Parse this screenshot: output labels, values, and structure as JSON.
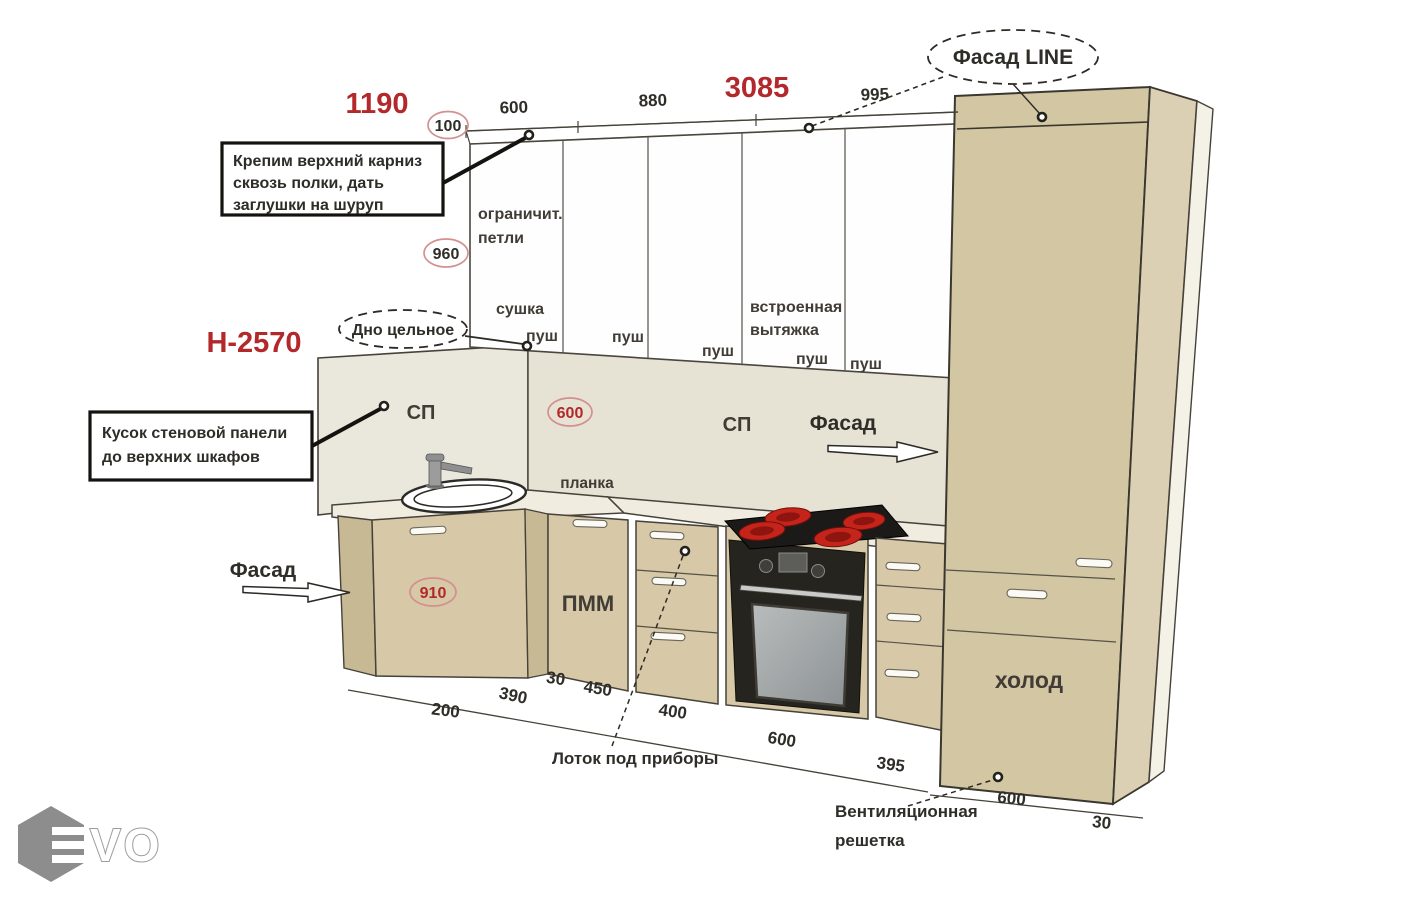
{
  "colors": {
    "accent_red": "#b3282a",
    "circle_stroke": "#d49090",
    "outline_dark": "#3a362e",
    "cabinet_tan": "#d7c9a7",
    "cabinet_tan_dark": "#c8b995",
    "tall_front": "#d3c6a3",
    "tall_side": "#dbd0b4",
    "backsplash": "#e7e3d4",
    "wall_panel": "#eae8dd",
    "countertop": "#f0ecdf",
    "door_white": "#fefefe",
    "oven_black": "#26241f",
    "oven_glass": "#9fa4a6",
    "burner_red": "#c5241b",
    "logo_gray": "#8d8d8d"
  },
  "top_dims": {
    "overall_left": "1190",
    "overall_right": "3085",
    "seg1": "600",
    "seg2": "880",
    "seg3": "995",
    "offset": "100"
  },
  "circles": {
    "c100": "100",
    "c960": "960",
    "c600": "600",
    "c910": "910"
  },
  "callouts": {
    "facade_line": "Фасад LINE",
    "solid_bottom": "Дно цельное",
    "cornice_note": [
      "Крепим верхний карниз",
      "сквозь полки, дать",
      "заглушки на шуруп"
    ],
    "wall_panel_note": [
      "Кусок стеновой панели",
      "до верхних шкафов"
    ],
    "cutlery_tray": "Лоток под приборы",
    "vent_grille": [
      "Вентиляционная",
      "решетка"
    ]
  },
  "labels": {
    "height_code": "Н-2570",
    "limit_hinges": [
      "ограничит.",
      "петли"
    ],
    "dryer": "сушка",
    "hood": [
      "встроенная",
      "вытяжка"
    ],
    "push": [
      "пуш",
      "пуш",
      "пуш",
      "пуш",
      "пуш"
    ],
    "sp_left": "СП",
    "sp_right": "СП",
    "facade_left": "Фасад",
    "facade_right": "Фасад",
    "planka": "планка",
    "pmm": "ПММ",
    "fridge": "холод"
  },
  "bottom_dims": [
    "200",
    "390",
    "30",
    "450",
    "400",
    "600",
    "395",
    "600",
    "30"
  ],
  "logo": {
    "vo": "VO"
  }
}
